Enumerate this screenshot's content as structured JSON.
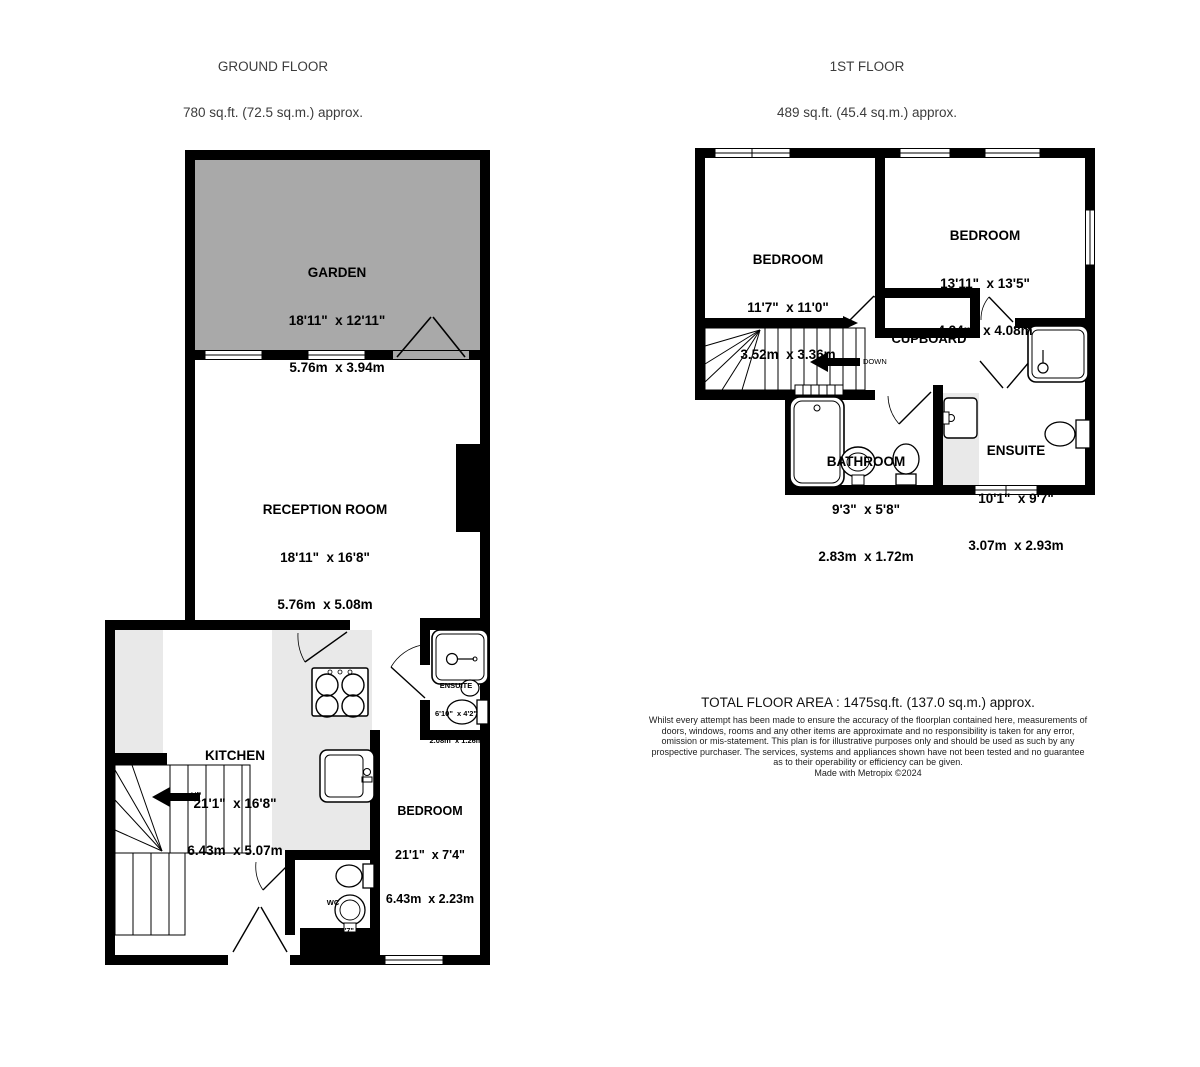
{
  "ground_floor": {
    "title": "GROUND FLOOR",
    "area": "780 sq.ft. (72.5 sq.m.) approx.",
    "stairs_label": "UP",
    "rooms": {
      "garden": {
        "name": "GARDEN",
        "imperial": "18'11\"  x 12'11\"",
        "metric": "5.76m  x 3.94m"
      },
      "reception": {
        "name": "RECEPTION ROOM",
        "imperial": "18'11\"  x 16'8\"",
        "metric": "5.76m  x 5.08m"
      },
      "kitchen": {
        "name": "KITCHEN",
        "imperial": "21'1\"  x 16'8\"",
        "metric": "6.43m  x 5.07m"
      },
      "bedroom": {
        "name": "BEDROOM",
        "imperial": "21'1\"  x 7'4\"",
        "metric": "6.43m  x 2.23m"
      },
      "ensuite": {
        "name": "ENSUITE",
        "imperial": "6'10\"  x 4'2\"",
        "metric": "2.08m  x 1.26m"
      },
      "wc": {
        "name": "WC",
        "imperial": "4'10\"  x 4'7\"",
        "metric": "1.46m  x 1.40m"
      }
    }
  },
  "first_floor": {
    "title": "1ST FLOOR",
    "area": "489 sq.ft. (45.4 sq.m.) approx.",
    "stairs_label": "DOWN",
    "rooms": {
      "bedroom_left": {
        "name": "BEDROOM",
        "imperial": "11'7\"  x 11'0\"",
        "metric": "3.52m  x 3.36m"
      },
      "bedroom_right": {
        "name": "BEDROOM",
        "imperial": "13'11\"  x 13'5\"",
        "metric": "4.24m  x 4.08m"
      },
      "cupboard": {
        "name": "CUPBOARD"
      },
      "bathroom": {
        "name": "BATHROOM",
        "imperial": "9'3\"  x 5'8\"",
        "metric": "2.83m  x 1.72m"
      },
      "ensuite": {
        "name": "ENSUITE",
        "imperial": "10'1\"  x 9'7\"",
        "metric": "3.07m  x 2.93m"
      }
    }
  },
  "footer": {
    "total_area": "TOTAL FLOOR AREA : 1475sq.ft. (137.0 sq.m.) approx.",
    "disclaimer": "Whilst every attempt has been made to ensure the accuracy of the floorplan contained here, measurements of doors, windows, rooms and any other items are approximate and no responsibility is taken for any error, omission or mis-statement. This plan is for illustrative purposes only and should be used as such by any prospective purchaser. The services, systems and appliances shown have not been tested and no guarantee as to their operability or efficiency can be given.",
    "made_with": "Made with Metropix ©2024"
  },
  "colors": {
    "wall": "#000000",
    "garden_fill": "#a9a9a9",
    "counter_fill": "#e9e9e9"
  }
}
